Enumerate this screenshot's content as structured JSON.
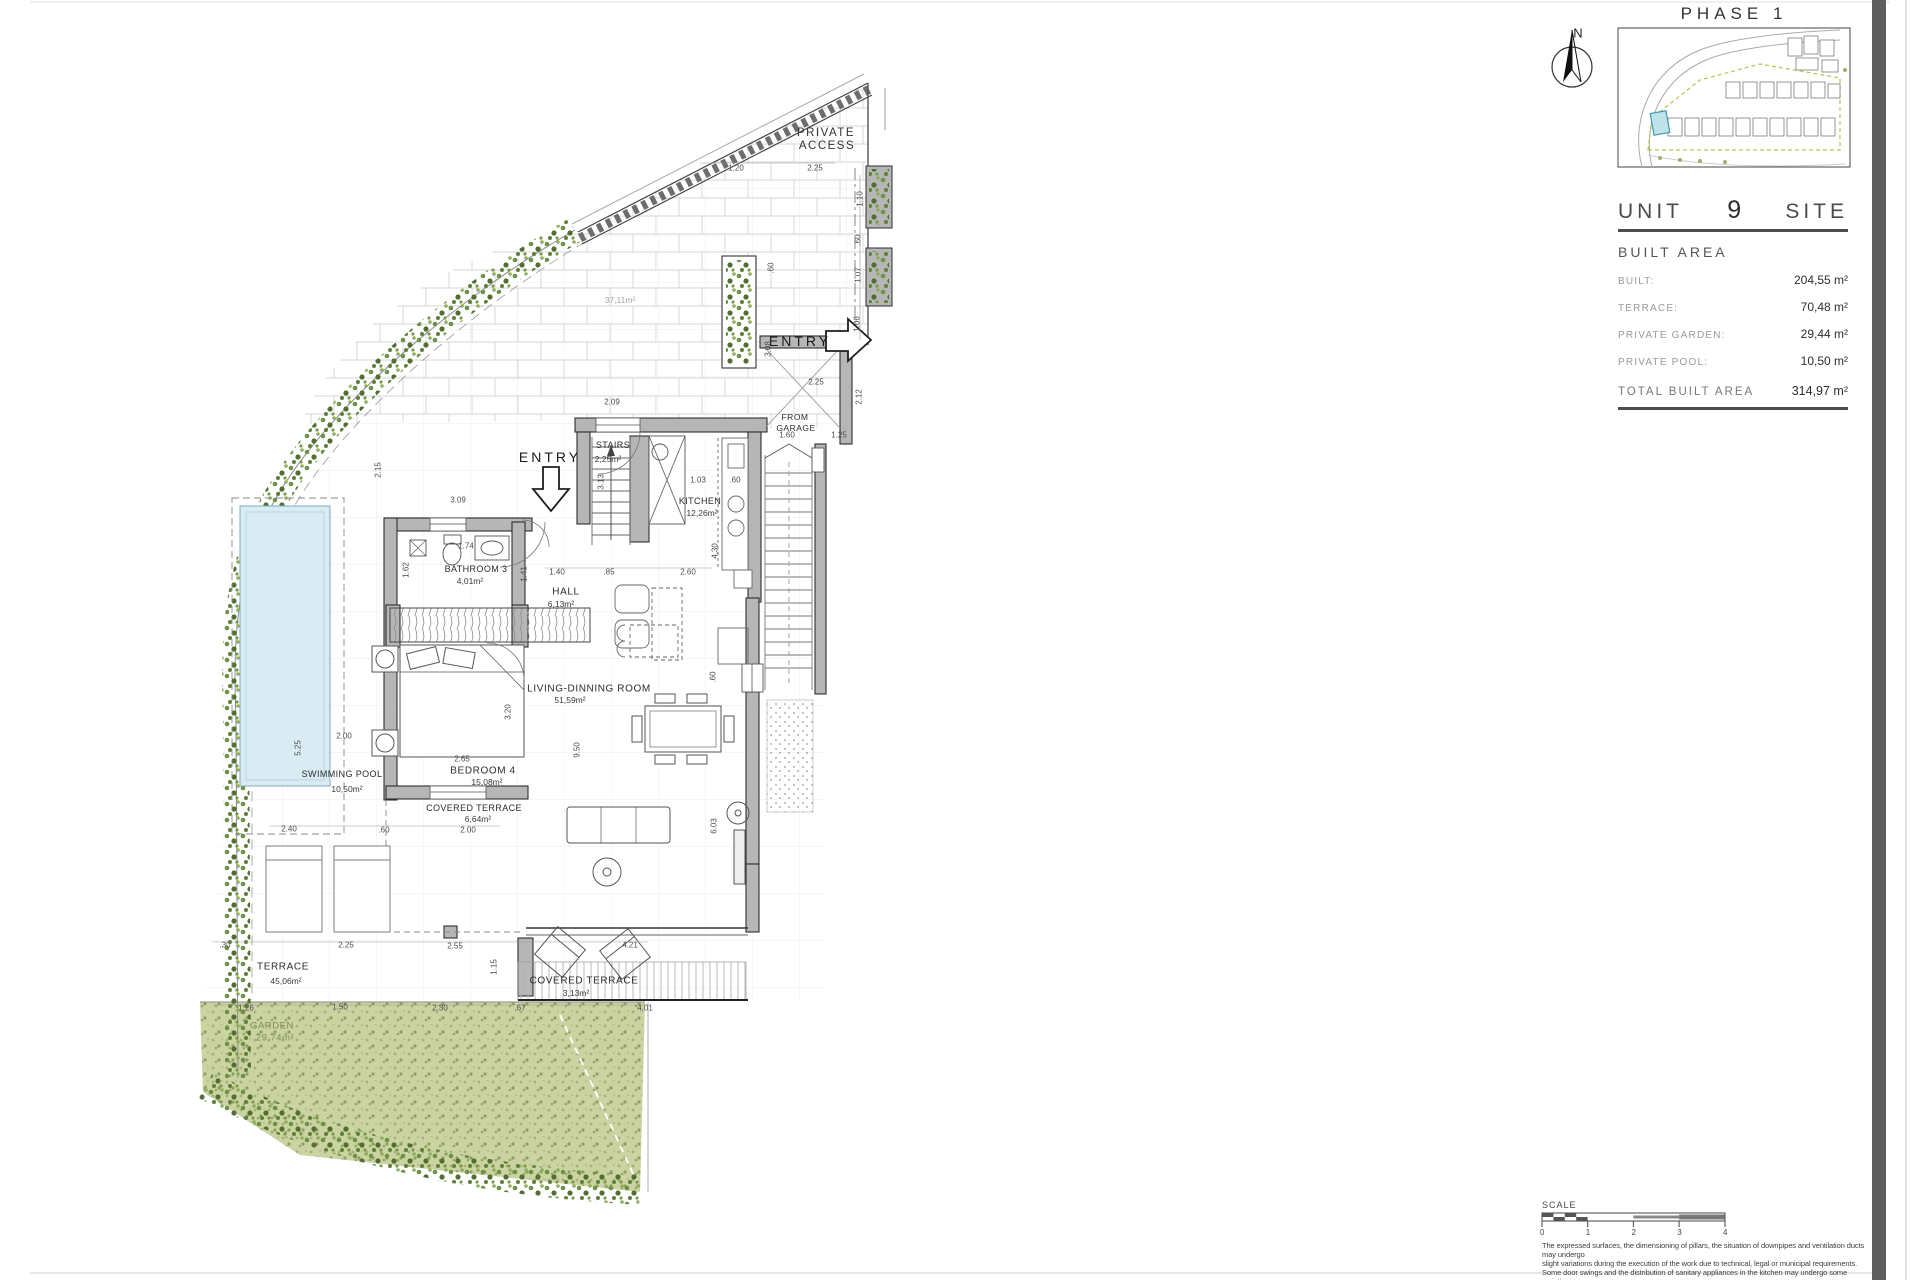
{
  "title_block": {
    "phase": "PHASE 1",
    "unit_label": "UNIT",
    "unit_number": "9",
    "site_label": "SITE",
    "built_area_title": "BUILT AREA",
    "rows": [
      {
        "label": "BUILT:",
        "value": "204,55 m²"
      },
      {
        "label": "TERRACE:",
        "value": "70,48 m²"
      },
      {
        "label": "PRIVATE GARDEN:",
        "value": "29,44 m²"
      },
      {
        "label": "PRIVATE POOL:",
        "value": "10,50 m²"
      }
    ],
    "total": {
      "label": "TOTAL BUILT AREA",
      "value": "314,97 m²"
    }
  },
  "scale": {
    "label": "SCALE",
    "ticks": [
      "0",
      "1",
      "2",
      "3",
      "4"
    ]
  },
  "disclaimer": {
    "lines": [
      "The expressed surfaces, the dimensioning of pillars, the situation of downpipes and ventilation ducts may undergo",
      "slight variations during the execution of the work due to technical, legal or municipal requirements.",
      "Some door swings and the distribution of sanitary appliances in the kitchen may undergo some variation.",
      "The overhang of the kitchen centertops is in the choice of custom specifications.",
      "The furniture is merely informative and the materials will be those represented in the specifications."
    ]
  },
  "plan": {
    "labels": [
      {
        "t": "PRIVATE",
        "x": 826,
        "y": 133,
        "c": "mid"
      },
      {
        "t": "ACCESS",
        "x": 827,
        "y": 146,
        "c": "mid"
      },
      {
        "t": "ENTRY",
        "x": 800,
        "y": 341,
        "c": "entry"
      },
      {
        "t": "ENTRY",
        "x": 550,
        "y": 457,
        "c": "entry"
      },
      {
        "t": "STAIRS",
        "x": 613,
        "y": 445,
        "c": "room-sm"
      },
      {
        "t": "2,25m²",
        "x": 608,
        "y": 459,
        "c": "area"
      },
      {
        "t": "KITCHEN",
        "x": 700,
        "y": 501,
        "c": "room-sm"
      },
      {
        "t": "12,26m²",
        "x": 702,
        "y": 513,
        "c": "area"
      },
      {
        "t": "FROM",
        "x": 795,
        "y": 417,
        "c": "tiny"
      },
      {
        "t": "GARAGE",
        "x": 796,
        "y": 428,
        "c": "tiny"
      },
      {
        "t": "HALL",
        "x": 566,
        "y": 592,
        "c": "room"
      },
      {
        "t": "6,13m²",
        "x": 561,
        "y": 604,
        "c": "area"
      },
      {
        "t": "BATHROOM 3",
        "x": 476,
        "y": 569,
        "c": "room-sm"
      },
      {
        "t": "4,01m²",
        "x": 470,
        "y": 581,
        "c": "area"
      },
      {
        "t": "LIVING-DINNING ROOM",
        "x": 589,
        "y": 689,
        "c": "room"
      },
      {
        "t": "51,59m²",
        "x": 570,
        "y": 700,
        "c": "area"
      },
      {
        "t": "BEDROOM 4",
        "x": 483,
        "y": 771,
        "c": "room"
      },
      {
        "t": "15,08m²",
        "x": 487,
        "y": 782,
        "c": "area"
      },
      {
        "t": "SWIMMING POOL",
        "x": 342,
        "y": 774,
        "c": "room-sm"
      },
      {
        "t": "10,50m²",
        "x": 347,
        "y": 789,
        "c": "area"
      },
      {
        "t": "COVERED TERRACE",
        "x": 474,
        "y": 808,
        "c": "room-sm"
      },
      {
        "t": "6,64m²",
        "x": 478,
        "y": 819,
        "c": "area"
      },
      {
        "t": "COVERED TERRACE",
        "x": 584,
        "y": 981,
        "c": "room"
      },
      {
        "t": "3,13m²",
        "x": 576,
        "y": 993,
        "c": "area"
      },
      {
        "t": "TERRACE",
        "x": 283,
        "y": 967,
        "c": "room"
      },
      {
        "t": "45,06m²",
        "x": 286,
        "y": 981,
        "c": "area"
      },
      {
        "t": "GARDEN",
        "x": 272,
        "y": 1026,
        "c": "garden"
      },
      {
        "t": "29,74m²",
        "x": 275,
        "y": 1038,
        "c": "garden"
      },
      {
        "t": "37,11m²",
        "x": 620,
        "y": 300,
        "c": "faint"
      },
      {
        "t": "N",
        "x": 1578,
        "y": 33,
        "c": "north"
      }
    ],
    "dims": [
      {
        "t": "1.20",
        "x": 736,
        "y": 168
      },
      {
        "t": "2.25",
        "x": 815,
        "y": 168
      },
      {
        "t": "1.10",
        "x": 860,
        "y": 199,
        "v": 1
      },
      {
        "t": ".60",
        "x": 858,
        "y": 240,
        "v": 1
      },
      {
        "t": "1.07",
        "x": 858,
        "y": 275,
        "v": 1
      },
      {
        "t": "1.06",
        "x": 857,
        "y": 324,
        "v": 1
      },
      {
        "t": ".60",
        "x": 771,
        "y": 268,
        "v": 1
      },
      {
        "t": "3.08",
        "x": 768,
        "y": 349,
        "v": 1
      },
      {
        "t": "2.25",
        "x": 816,
        "y": 382
      },
      {
        "t": "2.12",
        "x": 859,
        "y": 397,
        "v": 1
      },
      {
        "t": "1.25",
        "x": 839,
        "y": 435
      },
      {
        "t": "1.60",
        "x": 787,
        "y": 435
      },
      {
        "t": "2.09",
        "x": 612,
        "y": 402
      },
      {
        "t": "1.03",
        "x": 698,
        "y": 480
      },
      {
        "t": ".60",
        "x": 735,
        "y": 480
      },
      {
        "t": "4.30",
        "x": 715,
        "y": 551,
        "v": 1
      },
      {
        "t": "3.13",
        "x": 601,
        "y": 482,
        "v": 1
      },
      {
        "t": "2.60",
        "x": 688,
        "y": 572
      },
      {
        "t": ".85",
        "x": 609,
        "y": 572
      },
      {
        "t": "1.40",
        "x": 557,
        "y": 572
      },
      {
        "t": "2.15",
        "x": 378,
        "y": 470,
        "v": 1
      },
      {
        "t": "3.09",
        "x": 458,
        "y": 500
      },
      {
        "t": "1.74",
        "x": 466,
        "y": 546
      },
      {
        "t": "1.62",
        "x": 406,
        "y": 570,
        "v": 1
      },
      {
        "t": "1.41",
        "x": 524,
        "y": 574,
        "v": 1
      },
      {
        "t": "2.00",
        "x": 344,
        "y": 736
      },
      {
        "t": "5.25",
        "x": 298,
        "y": 748,
        "v": 1
      },
      {
        "t": "2.65",
        "x": 462,
        "y": 759
      },
      {
        "t": "3.20",
        "x": 508,
        "y": 712,
        "v": 1
      },
      {
        "t": "2.40",
        "x": 289,
        "y": 829
      },
      {
        "t": ".60",
        "x": 384,
        "y": 830
      },
      {
        "t": "2.00",
        "x": 468,
        "y": 830
      },
      {
        "t": "6.03",
        "x": 714,
        "y": 826,
        "v": 1
      },
      {
        "t": ".60",
        "x": 713,
        "y": 677,
        "v": 1
      },
      {
        "t": "9.50",
        "x": 577,
        "y": 750,
        "v": 1
      },
      {
        "t": "2.55",
        "x": 455,
        "y": 946
      },
      {
        "t": "4.21",
        "x": 630,
        "y": 945
      },
      {
        "t": "1.15",
        "x": 494,
        "y": 967,
        "v": 1
      },
      {
        "t": ".30",
        "x": 225,
        "y": 945
      },
      {
        "t": "2.25",
        "x": 346,
        "y": 945
      },
      {
        "t": "1.26",
        "x": 246,
        "y": 1008
      },
      {
        "t": "1.50",
        "x": 340,
        "y": 1007
      },
      {
        "t": ".67",
        "x": 520,
        "y": 1008
      },
      {
        "t": "2.30",
        "x": 440,
        "y": 1008
      },
      {
        "t": "4.01",
        "x": 645,
        "y": 1008
      }
    ]
  },
  "colors": {
    "wall": "#b6b6b6",
    "pool": "#d9ebf3",
    "garden": "#ccd3a2",
    "hedge": "#5d8038",
    "unit_highlight": "#bfe3ea",
    "sidebar_bar": "#5e5e5e"
  }
}
